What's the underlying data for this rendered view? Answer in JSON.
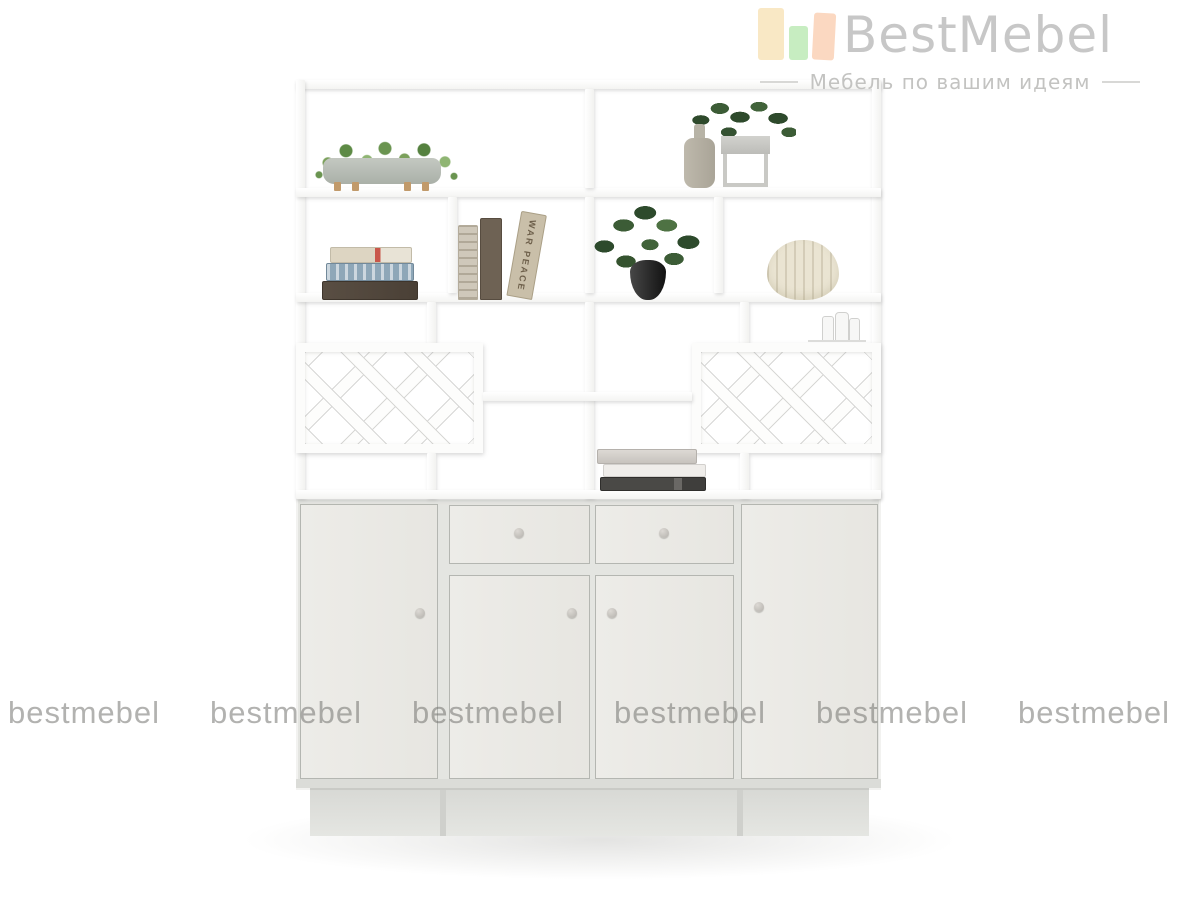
{
  "page": {
    "background": "#ffffff"
  },
  "brand": {
    "logo_text": "BestMebel",
    "tagline": "Мебель по вашим идеям",
    "logo_text_color": "#c7c7c7",
    "logo_bar_colors": [
      "#f9e8c5",
      "#c7edc1",
      "#fbd8c1"
    ]
  },
  "watermark": {
    "text": "bestmebel",
    "count": 6,
    "color": "#737370"
  },
  "product": {
    "type": "white-shelving-unit-with-cabinet-base",
    "frame_color": "#fcfcfb",
    "panel_color": "#e9e8e4",
    "wine_rack_sections": 2,
    "drawer_count": 2,
    "door_count": 4,
    "knob_count": 6
  },
  "decor": {
    "row1_left": "trailing-plant-in-concrete-trough",
    "row1_right_items": [
      "beige-bottle-vase",
      "potted-plant-on-stand"
    ],
    "row2_items": [
      "stack-of-three-books",
      "leaning-books",
      "dark-potted-plant",
      "ribbed-cream-vase"
    ],
    "row3_item": "glass-miniature-set",
    "cabinet_top_item": "stack-of-three-books",
    "book_spine_text": "WAR PEACE"
  }
}
